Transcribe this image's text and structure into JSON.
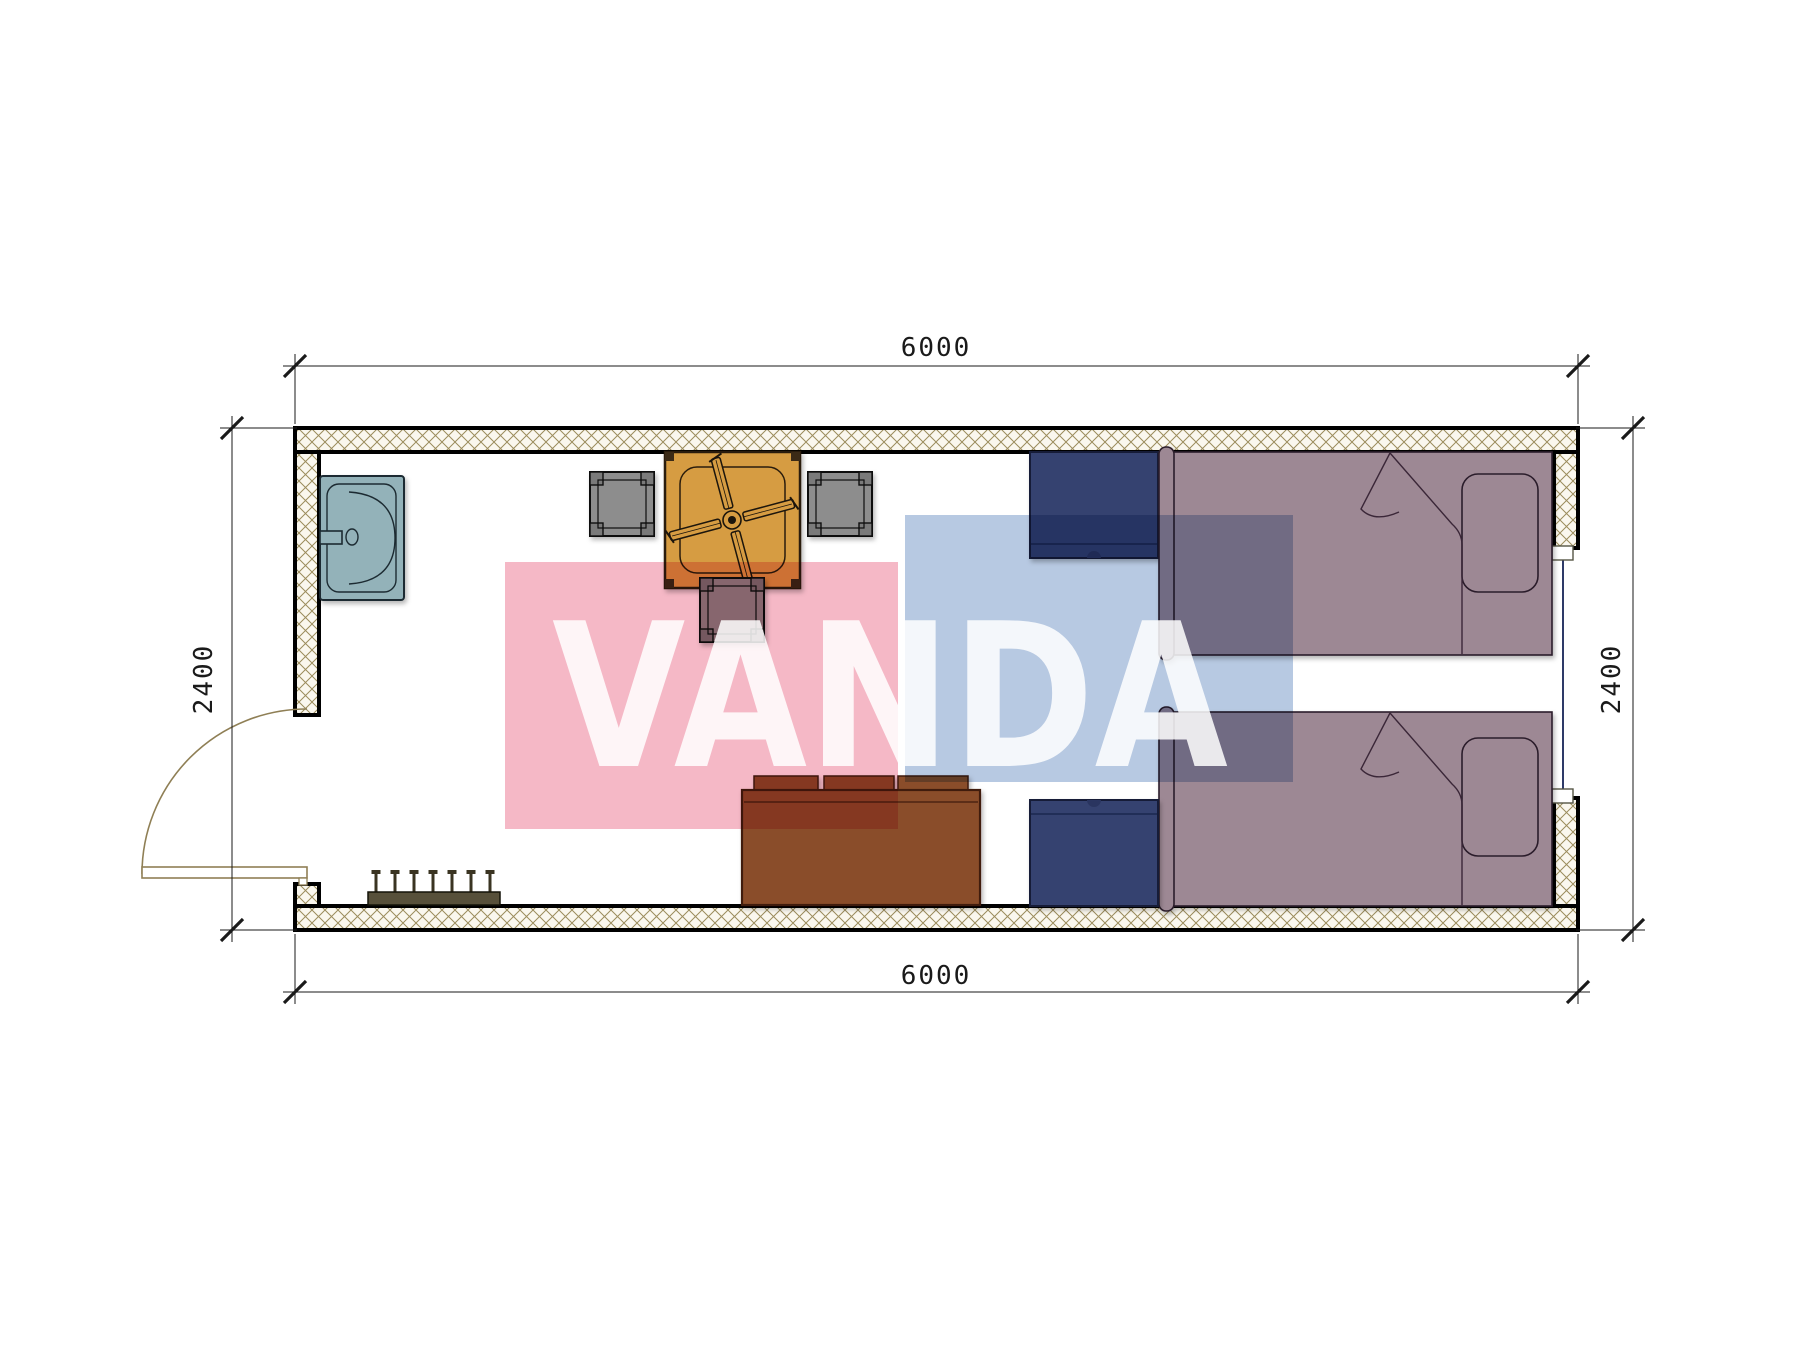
{
  "drawing": {
    "type": "floor-plan",
    "description": "single-room container plan, top view"
  },
  "dims": {
    "top": "6000",
    "bottom": "6000",
    "left": "2400",
    "right": "2400"
  },
  "watermark": {
    "text": "VANDA",
    "pink": "#f5b8c6",
    "blue": "#b7c9e2",
    "text_color": "#ffffff"
  },
  "colors": {
    "wall_fill": "#faf7ee",
    "wall_hatch": "#9b8c5c",
    "outline": "#000000",
    "sink": "#93b2b9",
    "table": "#d69c42",
    "table_trim": "#3a2a12",
    "stool": "#8d8d8d",
    "stool_leg": "#7a7a7a",
    "nightstand": "#35426f",
    "nightstand_knob": "#2b3660",
    "bed": "#9d8894",
    "bed_line": "#3a2838",
    "sofa": "#8a4e2a",
    "sofa_line": "#401d10",
    "coat_rack": "#57503a",
    "hook": "#3a3422",
    "door": "#8f7f55",
    "glazing": "#2e3a68",
    "dim_text": "#1a1a1a"
  },
  "furniture": {
    "items": [
      "sink",
      "square-table",
      "ceiling-fan",
      "stool",
      "stool",
      "stool",
      "nightstand",
      "single-bed",
      "single-bed",
      "nightstand",
      "sofa",
      "coat-rack",
      "swing-door",
      "window"
    ]
  }
}
